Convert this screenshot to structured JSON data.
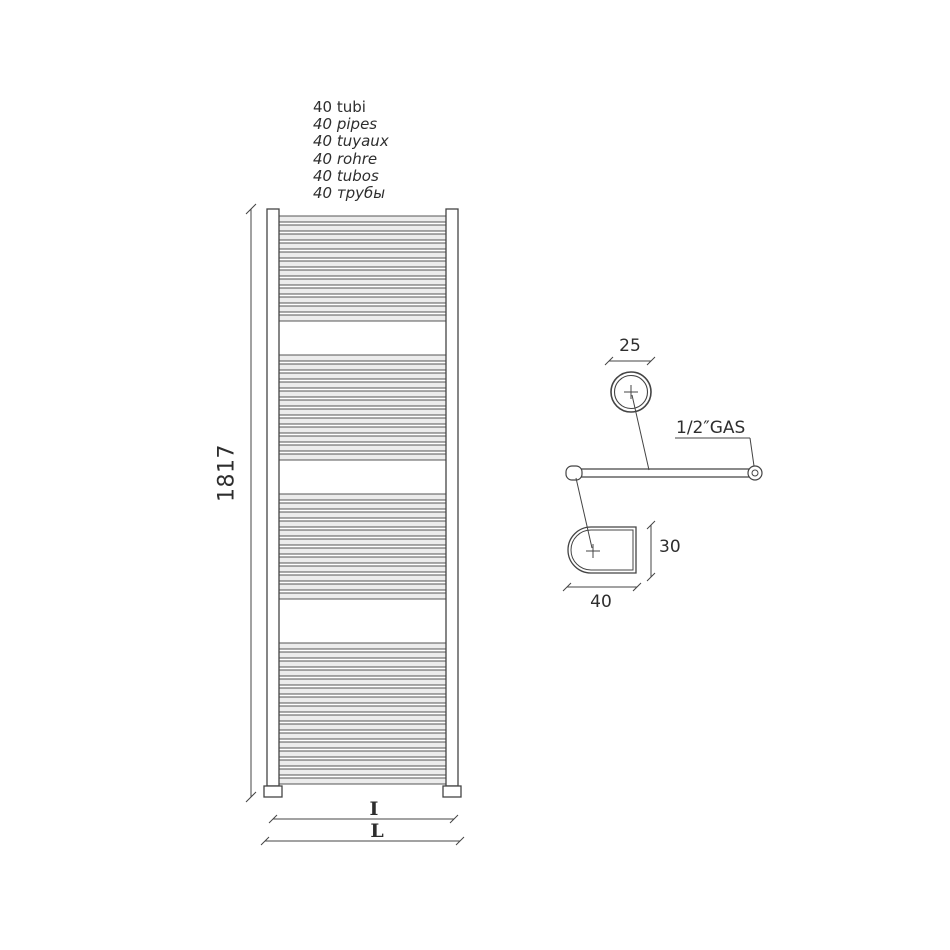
{
  "title": {
    "lines": [
      "40 tubi",
      "40 pipes",
      "40 tuyaux",
      "40 rohre",
      "40 tubos",
      "40 трубы"
    ]
  },
  "dimensions": {
    "height_mm": "1817",
    "inner_width_label": "I",
    "overall_width_label": "L",
    "tube_diameter_mm": "25",
    "collector_depth_mm": "30",
    "collector_width_mm": "40",
    "connection_thread": "1/2″GAS"
  },
  "radiator": {
    "tube_count": 40,
    "groups": [
      {
        "tubes": 12
      },
      {
        "tubes": 12
      },
      {
        "tubes": 12
      },
      {
        "tubes": 16
      }
    ]
  },
  "colors": {
    "line": "#444444",
    "text": "#2e2e2e",
    "tube_fill": "#ececec",
    "tube_edge": "#555555",
    "background": "#ffffff"
  }
}
